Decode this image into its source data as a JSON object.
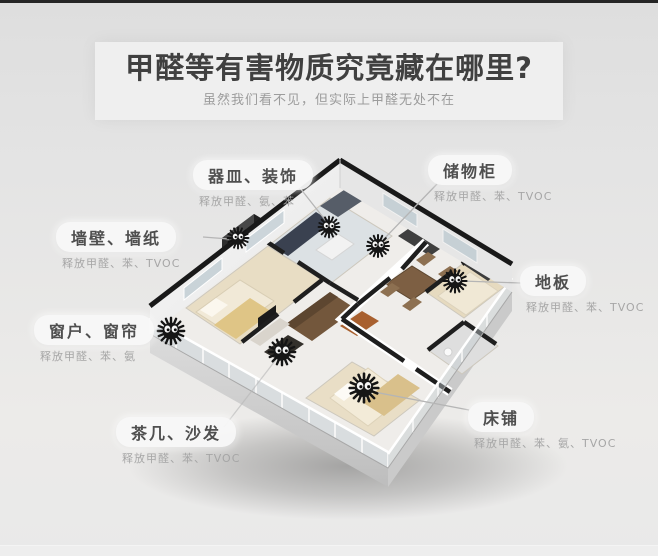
{
  "header": {
    "title": "甲醛等有害物质究竟藏在哪里?",
    "subtitle": "虽然我们看不见，但实际上甲醛无处不在"
  },
  "callouts": [
    {
      "label": "器皿、装饰",
      "sub": "释放甲醛、氨、苯"
    },
    {
      "label": "储物柜",
      "sub": "释放甲醛、苯、TVOC"
    },
    {
      "label": "墙壁、墙纸",
      "sub": "释放甲醛、苯、TVOC"
    },
    {
      "label": "地板",
      "sub": "释放甲醛、苯、TVOC"
    },
    {
      "label": "窗户、窗帘",
      "sub": "释放甲醛、苯、氨"
    },
    {
      "label": "茶几、沙发",
      "sub": "释放甲醛、苯、TVOC"
    },
    {
      "label": "床铺",
      "sub": "释放甲醛、苯、氨、TVOC"
    }
  ],
  "illustration": {
    "marker_icon": "soot-sprite-icon",
    "marker_count": 7
  },
  "colors": {
    "background": "#e2e2e2",
    "top_bar": "#252525",
    "title_text": "#404040",
    "subtitle_text": "#9c9c9c",
    "pill_text": "#4f4f4f",
    "sub_text": "#a6a6a6",
    "wall_dark": "#1d1d1d",
    "floor_beige": "#e8ddc4",
    "connector_line": "#b5b5b5"
  }
}
